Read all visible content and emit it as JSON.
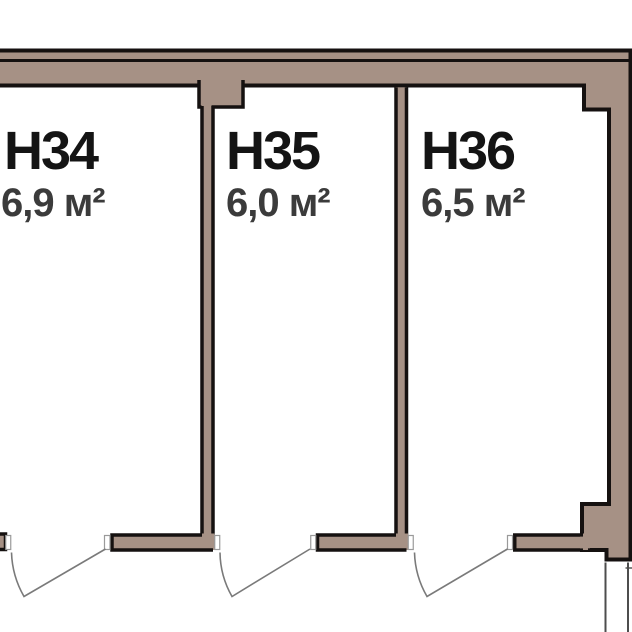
{
  "plan": {
    "title": "storage-rooms-floor-plan",
    "rooms": [
      {
        "id": "H34",
        "label": "Н34",
        "area": "6,9 м²"
      },
      {
        "id": "H35",
        "label": "Н35",
        "area": "6,0 м²"
      },
      {
        "id": "H36",
        "label": "Н36",
        "area": "6,5 м²"
      }
    ],
    "colors": {
      "wall_fill": "#a69185",
      "outline": "#151110",
      "door_line": "#7a7a7a",
      "jamb_fill": "#ffffff",
      "jamb_stroke": "#9a9a9a",
      "opening_line": "#4d4d4d",
      "label_color": "#141414",
      "area_color": "#3b3b3b",
      "background": "#ffffff"
    }
  }
}
